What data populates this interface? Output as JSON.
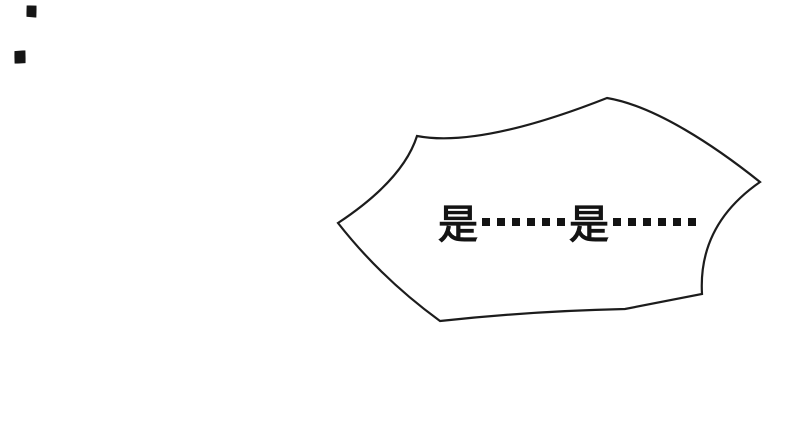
{
  "panel": {
    "background_color": "#ffffff"
  },
  "speech_bubble": {
    "text": "是……是……",
    "first_word": "是",
    "second_word": "是",
    "ellipsis": "……",
    "ellipsis_dot_count": 6,
    "fill_color": "#ffffff",
    "outline_color": "#1c1c1c",
    "text_color": "#131313"
  },
  "ink_specks": {
    "count": 2,
    "color": "#151515"
  }
}
